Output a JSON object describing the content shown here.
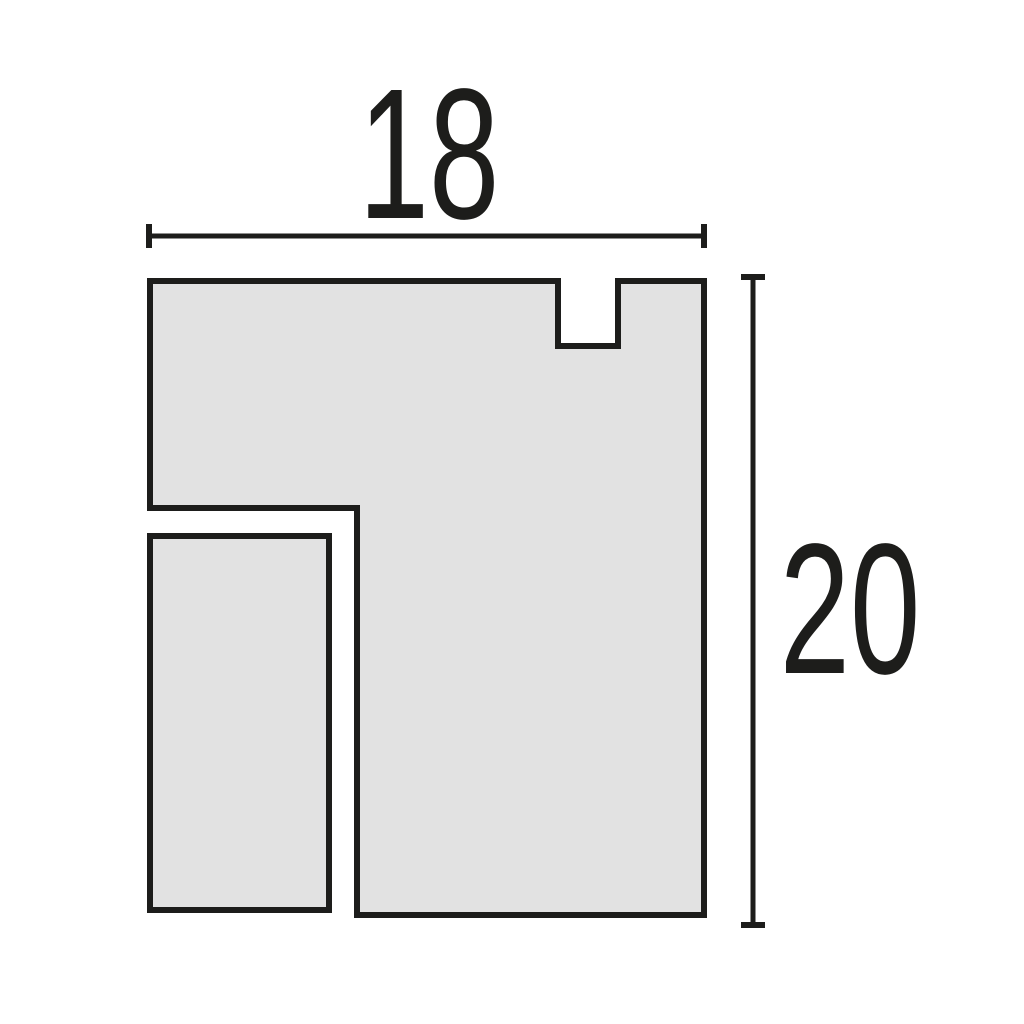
{
  "dimensions": {
    "width_label": "18",
    "height_label": "20"
  },
  "colors": {
    "background": "#ffffff",
    "shape_fill": "#e2e2e2",
    "line": "#1d1d1b"
  }
}
